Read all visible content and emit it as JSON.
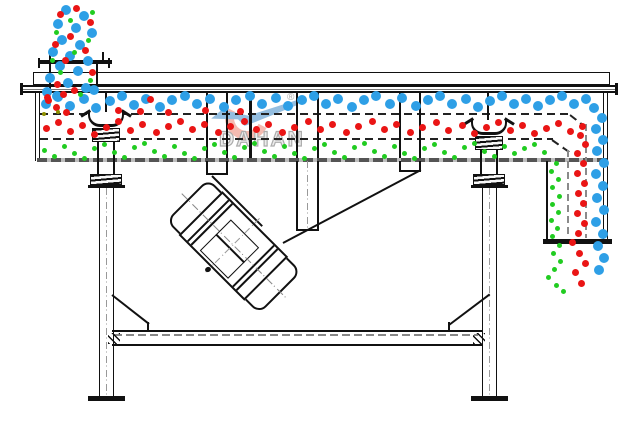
{
  "brand": {
    "name": "DAHAN",
    "registered": "®"
  },
  "diagram": {
    "type": "linear-vibrating-screen-cross-section",
    "particle_colors": {
      "large": "#2e9fe6",
      "medium": "#ea1515",
      "fine": "#21cc21",
      "stray": "#8f9000"
    },
    "line_color": "#111111"
  },
  "dot_styles": {
    "blue": {
      "size": 10,
      "color": "#2e9fe6"
    },
    "red": {
      "size": 7,
      "color": "#ea1515"
    },
    "green": {
      "size": 5,
      "color": "#21cc21"
    },
    "olive": {
      "size": 4,
      "color": "#8f9000"
    }
  },
  "dots": {
    "blue": {
      "feed_stream": [
        [
          66,
          10
        ],
        [
          84,
          16
        ],
        [
          58,
          24
        ],
        [
          76,
          28
        ],
        [
          92,
          33
        ],
        [
          62,
          40
        ],
        [
          80,
          45
        ],
        [
          53,
          52
        ],
        [
          70,
          56
        ],
        [
          88,
          61
        ],
        [
          60,
          66
        ],
        [
          78,
          71
        ],
        [
          50,
          78
        ],
        [
          68,
          83
        ],
        [
          86,
          88
        ],
        [
          47,
          92
        ],
        [
          94,
          90
        ],
        [
          57,
          96
        ]
      ],
      "top_deck_layer": [
        [
          46,
          104
        ],
        [
          58,
          97
        ],
        [
          70,
          106
        ],
        [
          84,
          99
        ],
        [
          96,
          108
        ],
        [
          110,
          101
        ],
        [
          122,
          96
        ],
        [
          134,
          105
        ],
        [
          146,
          99
        ],
        [
          160,
          107
        ],
        [
          172,
          100
        ],
        [
          185,
          96
        ],
        [
          197,
          104
        ],
        [
          210,
          99
        ],
        [
          224,
          107
        ],
        [
          236,
          100
        ],
        [
          250,
          96
        ],
        [
          262,
          104
        ],
        [
          276,
          98
        ],
        [
          288,
          106
        ],
        [
          302,
          100
        ],
        [
          314,
          96
        ],
        [
          326,
          104
        ],
        [
          338,
          99
        ],
        [
          352,
          107
        ],
        [
          364,
          100
        ],
        [
          376,
          96
        ],
        [
          390,
          104
        ],
        [
          402,
          98
        ],
        [
          416,
          106
        ],
        [
          428,
          100
        ],
        [
          440,
          96
        ],
        [
          452,
          104
        ],
        [
          466,
          99
        ],
        [
          478,
          107
        ],
        [
          490,
          101
        ],
        [
          502,
          96
        ],
        [
          514,
          104
        ],
        [
          526,
          99
        ],
        [
          538,
          106
        ],
        [
          550,
          100
        ],
        [
          562,
          96
        ],
        [
          574,
          104
        ],
        [
          586,
          99
        ]
      ],
      "discharge_column": [
        [
          594,
          108
        ],
        [
          602,
          118
        ],
        [
          596,
          129
        ],
        [
          603,
          140
        ],
        [
          597,
          151
        ],
        [
          604,
          163
        ],
        [
          596,
          174
        ],
        [
          603,
          186
        ],
        [
          597,
          198
        ],
        [
          604,
          210
        ],
        [
          596,
          222
        ],
        [
          603,
          234
        ],
        [
          598,
          246
        ],
        [
          604,
          258
        ],
        [
          599,
          270
        ]
      ]
    },
    "red": {
      "feed_stream": [
        [
          76,
          8
        ],
        [
          60,
          14
        ],
        [
          90,
          22
        ],
        [
          70,
          36
        ],
        [
          55,
          44
        ],
        [
          85,
          50
        ],
        [
          65,
          60
        ],
        [
          92,
          72
        ],
        [
          57,
          84
        ],
        [
          74,
          90
        ],
        [
          63,
          94
        ],
        [
          47,
          97
        ]
      ],
      "sinking_in_top_layer": [
        [
          118,
          110
        ],
        [
          140,
          111
        ],
        [
          168,
          112
        ],
        [
          205,
          110
        ],
        [
          240,
          111
        ],
        [
          150,
          99
        ],
        [
          56,
          107
        ],
        [
          66,
          112
        ],
        [
          48,
          100
        ]
      ],
      "middle_deck_layer": [
        [
          46,
          128
        ],
        [
          58,
          122
        ],
        [
          70,
          131
        ],
        [
          82,
          125
        ],
        [
          94,
          134
        ],
        [
          106,
          127
        ],
        [
          118,
          121
        ],
        [
          130,
          130
        ],
        [
          142,
          124
        ],
        [
          156,
          132
        ],
        [
          168,
          126
        ],
        [
          180,
          121
        ],
        [
          192,
          129
        ],
        [
          204,
          124
        ],
        [
          218,
          132
        ],
        [
          230,
          126
        ],
        [
          244,
          121
        ],
        [
          256,
          129
        ],
        [
          268,
          124
        ],
        [
          282,
          132
        ],
        [
          294,
          127
        ],
        [
          308,
          121
        ],
        [
          320,
          129
        ],
        [
          332,
          124
        ],
        [
          346,
          132
        ],
        [
          358,
          126
        ],
        [
          372,
          121
        ],
        [
          384,
          129
        ],
        [
          396,
          124
        ],
        [
          410,
          132
        ],
        [
          422,
          127
        ],
        [
          436,
          122
        ],
        [
          448,
          130
        ],
        [
          462,
          125
        ],
        [
          474,
          133
        ],
        [
          486,
          127
        ],
        [
          498,
          122
        ],
        [
          510,
          130
        ],
        [
          522,
          125
        ],
        [
          534,
          133
        ],
        [
          546,
          128
        ],
        [
          558,
          123
        ],
        [
          570,
          131
        ],
        [
          582,
          126
        ]
      ],
      "discharge_column": [
        [
          580,
          135
        ],
        [
          585,
          144
        ],
        [
          577,
          153
        ],
        [
          583,
          163
        ],
        [
          577,
          173
        ],
        [
          584,
          183
        ],
        [
          578,
          193
        ],
        [
          583,
          203
        ],
        [
          577,
          213
        ],
        [
          584,
          223
        ],
        [
          578,
          233
        ],
        [
          572,
          242
        ],
        [
          579,
          253
        ],
        [
          585,
          263
        ],
        [
          575,
          272
        ],
        [
          581,
          283
        ]
      ]
    },
    "green": {
      "feed_stream": [
        [
          92,
          12
        ],
        [
          70,
          20
        ],
        [
          56,
          32
        ],
        [
          88,
          40
        ],
        [
          74,
          52
        ],
        [
          52,
          60
        ],
        [
          60,
          72
        ],
        [
          90,
          80
        ],
        [
          80,
          94
        ]
      ],
      "bottom_deck_layer": [
        [
          44,
          150
        ],
        [
          54,
          156
        ],
        [
          64,
          146
        ],
        [
          74,
          153
        ],
        [
          84,
          158
        ],
        [
          94,
          148
        ],
        [
          104,
          144
        ],
        [
          114,
          152
        ],
        [
          124,
          157
        ],
        [
          134,
          147
        ],
        [
          144,
          143
        ],
        [
          154,
          151
        ],
        [
          164,
          156
        ],
        [
          174,
          146
        ],
        [
          184,
          153
        ],
        [
          194,
          158
        ],
        [
          204,
          148
        ],
        [
          214,
          144
        ],
        [
          224,
          152
        ],
        [
          234,
          157
        ],
        [
          244,
          147
        ],
        [
          254,
          143
        ],
        [
          264,
          151
        ],
        [
          274,
          156
        ],
        [
          284,
          146
        ],
        [
          294,
          153
        ],
        [
          304,
          158
        ],
        [
          314,
          148
        ],
        [
          324,
          144
        ],
        [
          334,
          152
        ],
        [
          344,
          157
        ],
        [
          354,
          147
        ],
        [
          364,
          143
        ],
        [
          374,
          151
        ],
        [
          384,
          156
        ],
        [
          394,
          146
        ],
        [
          404,
          153
        ],
        [
          414,
          158
        ],
        [
          424,
          148
        ],
        [
          434,
          144
        ],
        [
          444,
          152
        ],
        [
          454,
          157
        ],
        [
          464,
          147
        ],
        [
          474,
          143
        ],
        [
          484,
          151
        ],
        [
          494,
          156
        ],
        [
          504,
          146
        ],
        [
          514,
          153
        ],
        [
          524,
          148
        ],
        [
          534,
          144
        ],
        [
          544,
          152
        ]
      ],
      "discharge_column": [
        [
          556,
          163
        ],
        [
          551,
          171
        ],
        [
          558,
          179
        ],
        [
          552,
          187
        ],
        [
          559,
          196
        ],
        [
          552,
          204
        ],
        [
          558,
          212
        ],
        [
          551,
          220
        ],
        [
          557,
          228
        ],
        [
          552,
          236
        ],
        [
          559,
          245
        ],
        [
          553,
          253
        ],
        [
          560,
          261
        ],
        [
          554,
          269
        ],
        [
          548,
          277
        ],
        [
          556,
          285
        ],
        [
          563,
          291
        ]
      ]
    },
    "olive": {
      "stray": [
        [
          44,
          114
        ],
        [
          58,
          112
        ]
      ]
    }
  }
}
